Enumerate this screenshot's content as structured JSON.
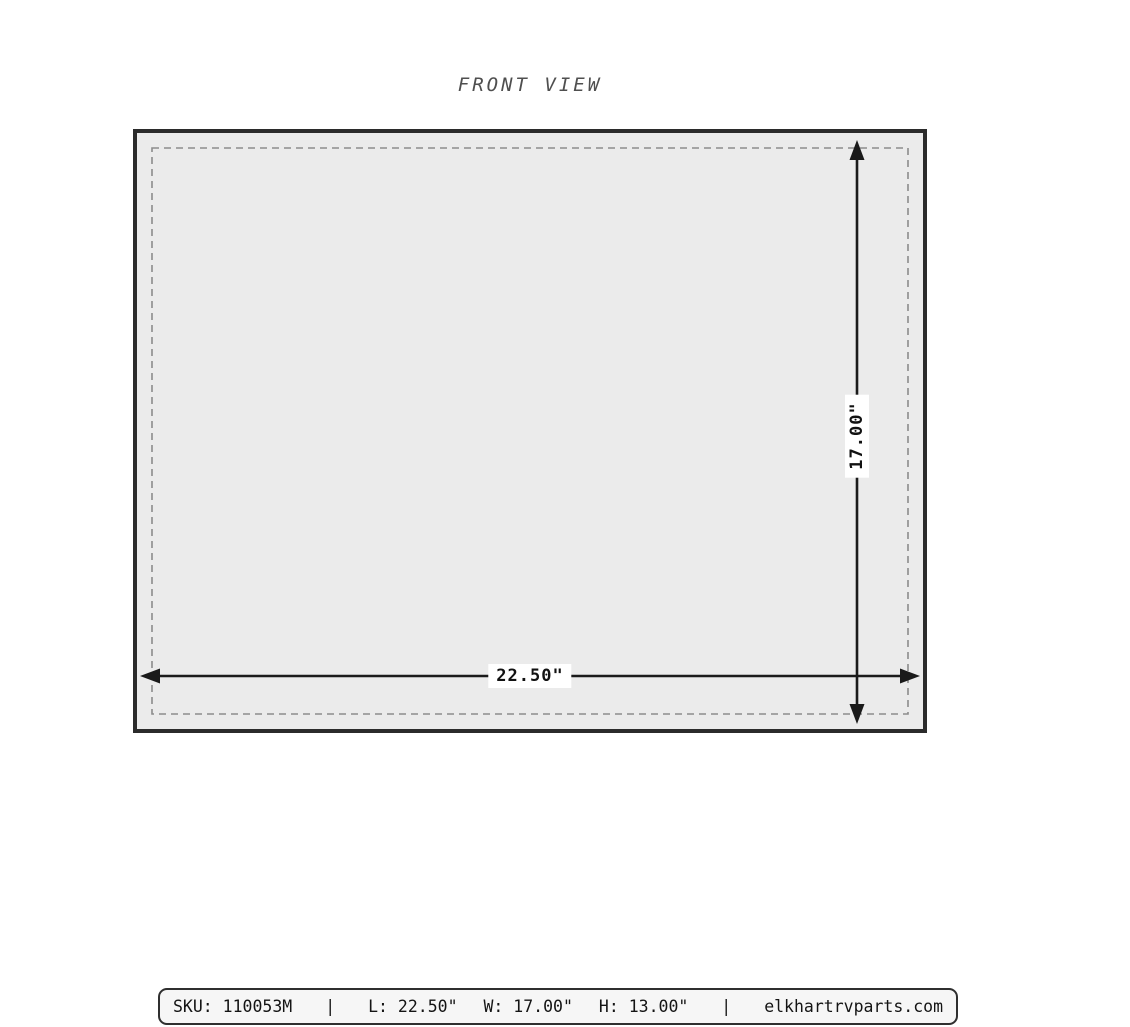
{
  "title": "FRONT VIEW",
  "drawing": {
    "width_label": "22.50\"",
    "height_label": "17.00\""
  },
  "footer": {
    "sku": "SKU: 110053M",
    "separator": "|",
    "length": "L: 22.50\"",
    "width": "W: 17.00\"",
    "height": "H: 13.00\"",
    "website": "elkhartrvparts.com"
  },
  "colors": {
    "panel_fill": "#ebebeb",
    "panel_border": "#2b2b2b",
    "dashed_outline": "#8c8c8c",
    "dimension_line": "#1a1a1a",
    "title_text": "#4f4f4f",
    "footer_fill": "#f6f6f6",
    "footer_border": "#2f2f2f",
    "background": "#ffffff"
  }
}
